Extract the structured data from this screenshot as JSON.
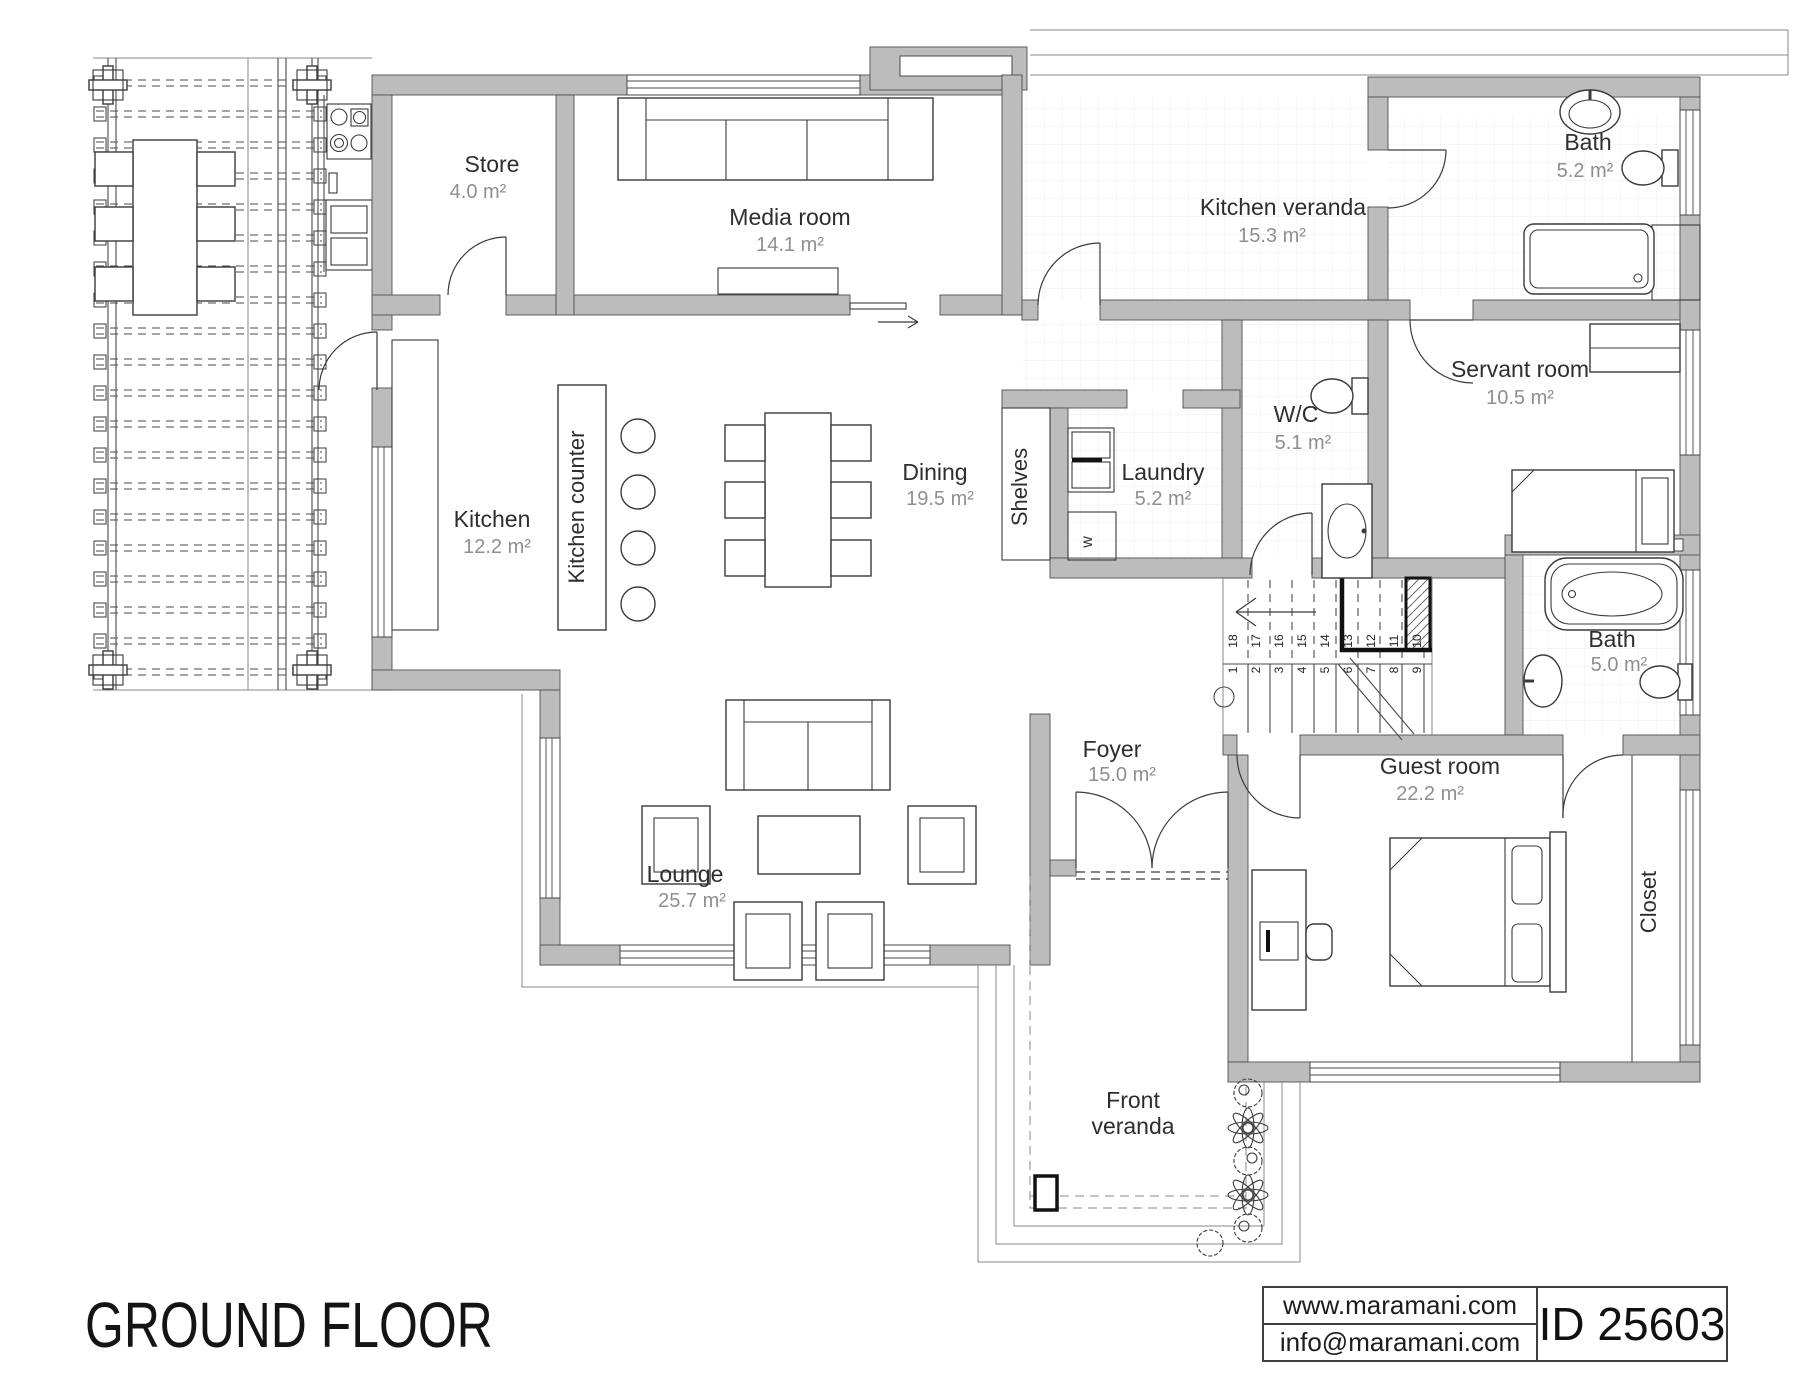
{
  "title": "GROUND FLOOR",
  "info_box": {
    "website": "www.maramani.com",
    "email": "info@maramani.com",
    "plan_id": "ID 25603"
  },
  "rooms": {
    "store": {
      "name": "Store",
      "area": "4.0 m²"
    },
    "media_room": {
      "name": "Media room",
      "area": "14.1 m²"
    },
    "kitchen_veranda": {
      "name": "Kitchen veranda",
      "area": "15.3 m²"
    },
    "bath_top": {
      "name": "Bath",
      "area": "5.2 m²"
    },
    "servant_room": {
      "name": "Servant room",
      "area": "10.5 m²"
    },
    "wc": {
      "name": "W/C",
      "area": "5.1 m²"
    },
    "laundry": {
      "name": "Laundry",
      "area": "5.2 m²"
    },
    "dining": {
      "name": "Dining",
      "area": "19.5 m²"
    },
    "kitchen": {
      "name": "Kitchen",
      "area": "12.2 m²"
    },
    "bath_mid": {
      "name": "Bath",
      "area": "5.0 m²"
    },
    "foyer": {
      "name": "Foyer",
      "area": "15.0 m²"
    },
    "guest_room": {
      "name": "Guest room",
      "area": "22.2 m²"
    },
    "lounge": {
      "name": "Lounge",
      "area": "25.7 m²"
    },
    "front_veranda": {
      "name_line1": "Front",
      "name_line2": "veranda"
    }
  },
  "labels": {
    "kitchen_counter": "Kitchen counter",
    "shelves": "Shelves",
    "closet": "Closet",
    "washer": "w"
  },
  "stairs": {
    "upper_treads": [
      "18",
      "17",
      "16",
      "15",
      "14",
      "13",
      "12",
      "11",
      "10"
    ],
    "lower_treads": [
      "1",
      "2",
      "3",
      "4",
      "5",
      "6",
      "7",
      "8",
      "9"
    ]
  },
  "colors": {
    "wall_fill": "#bcbcbc",
    "wall_stroke": "#4f4f4f",
    "room_name_text": "#2e2e2e",
    "area_text": "#8f8f8f"
  }
}
